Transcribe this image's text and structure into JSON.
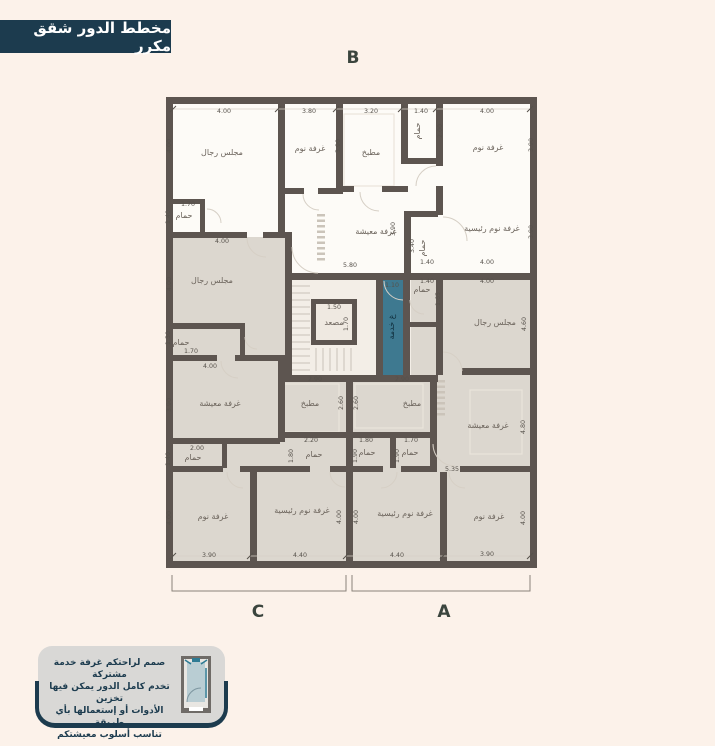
{
  "title": "مخطط الدور شقق مكرر",
  "section_labels": {
    "top": "B",
    "bottom_left": "C",
    "bottom_right": "A"
  },
  "note": {
    "lines": [
      "صمم لراحتكم غرفة خدمة مشتركة",
      "تخدم كامل الدور يمكن فيها تخزين",
      "الأدوات أو إستعمالها بأي طريقة",
      "تناسب أسلوب معيشتكم"
    ]
  },
  "colors": {
    "background": "#fcf2ea",
    "banner_navy": "#1c3b4e",
    "wall": "#5d5550",
    "room_beige": "#dcd7cf",
    "room_white": "#fdfbf7",
    "service_teal": "#3e7990",
    "note_gray": "#d9d8d6"
  },
  "plan": {
    "rooms": [
      {
        "t": "مجلس رجال",
        "x": 222,
        "y": 155
      },
      {
        "t": "غرفة نوم",
        "x": 310,
        "y": 151
      },
      {
        "t": "مطبخ",
        "x": 371,
        "y": 155
      },
      {
        "t": "حمام",
        "x": 420,
        "y": 131,
        "r": -90
      },
      {
        "t": "غرفة نوم",
        "x": 488,
        "y": 150
      },
      {
        "t": "حمام",
        "x": 184,
        "y": 218
      },
      {
        "t": "غرفة معيشة",
        "x": 376,
        "y": 234
      },
      {
        "t": "حمام",
        "x": 425,
        "y": 248,
        "r": -90
      },
      {
        "t": "غرفة نوم رئيسية",
        "x": 492,
        "y": 231
      },
      {
        "t": "مصعد",
        "x": 334,
        "y": 325
      },
      {
        "t": "غ خدمة",
        "x": 394,
        "y": 327,
        "r": -90,
        "c": "teal-label"
      },
      {
        "t": "مجلس رجال",
        "x": 212,
        "y": 283
      },
      {
        "t": "حمام",
        "x": 181,
        "y": 345
      },
      {
        "t": "غرفة معيشة",
        "x": 220,
        "y": 406
      },
      {
        "t": "حمام",
        "x": 193,
        "y": 460
      },
      {
        "t": "مطبخ",
        "x": 310,
        "y": 406
      },
      {
        "t": "حمام",
        "x": 314,
        "y": 457
      },
      {
        "t": "غرفة نوم",
        "x": 213,
        "y": 519
      },
      {
        "t": "غرفة نوم رئيسية",
        "x": 302,
        "y": 513
      },
      {
        "t": "حمام",
        "x": 422,
        "y": 292
      },
      {
        "t": "مجلس رجال",
        "x": 495,
        "y": 325
      },
      {
        "t": "مطبخ",
        "x": 412,
        "y": 406
      },
      {
        "t": "حمام",
        "x": 367,
        "y": 455
      },
      {
        "t": "حمام",
        "x": 410,
        "y": 455
      },
      {
        "t": "غرفة معيشة",
        "x": 488,
        "y": 428
      },
      {
        "t": "غرفة نوم رئيسية",
        "x": 405,
        "y": 516
      },
      {
        "t": "غرفة نوم",
        "x": 489,
        "y": 519
      }
    ],
    "dims": [
      {
        "t": "4.00",
        "x": 224,
        "y": 113
      },
      {
        "t": "3.80",
        "x": 309,
        "y": 113
      },
      {
        "t": "3.20",
        "x": 371,
        "y": 113
      },
      {
        "t": "1.40",
        "x": 421,
        "y": 113
      },
      {
        "t": "4.00",
        "x": 487,
        "y": 113
      },
      {
        "t": "4.00",
        "x": 171,
        "y": 146,
        "r": -90
      },
      {
        "t": "3.90",
        "x": 340,
        "y": 146,
        "r": -90
      },
      {
        "t": "2.00",
        "x": 442,
        "y": 131,
        "r": -90
      },
      {
        "t": "3.90",
        "x": 533,
        "y": 145,
        "r": -90
      },
      {
        "t": "1.70",
        "x": 188,
        "y": 206
      },
      {
        "t": "1.40",
        "x": 170,
        "y": 217,
        "r": -90
      },
      {
        "t": "3.90",
        "x": 395,
        "y": 229,
        "r": -90
      },
      {
        "t": "3.40",
        "x": 414,
        "y": 246,
        "r": -90
      },
      {
        "t": "3.90",
        "x": 533,
        "y": 232,
        "r": -90
      },
      {
        "t": "5.80",
        "x": 350,
        "y": 267
      },
      {
        "t": "1.40",
        "x": 427,
        "y": 264
      },
      {
        "t": "4.00",
        "x": 487,
        "y": 264
      },
      {
        "t": "1.40",
        "x": 427,
        "y": 283
      },
      {
        "t": "4.00",
        "x": 487,
        "y": 283
      },
      {
        "t": "1.10",
        "x": 392,
        "y": 287
      },
      {
        "t": "1.50",
        "x": 334,
        "y": 309
      },
      {
        "t": "1.70",
        "x": 348,
        "y": 324,
        "r": -90
      },
      {
        "t": "1.65",
        "x": 440,
        "y": 299,
        "r": -90
      },
      {
        "t": "4.00",
        "x": 222,
        "y": 243
      },
      {
        "t": "4.00",
        "x": 171,
        "y": 284,
        "r": -90
      },
      {
        "t": "4.60",
        "x": 526,
        "y": 324,
        "r": -90
      },
      {
        "t": "1.70",
        "x": 191,
        "y": 353
      },
      {
        "t": "1.30",
        "x": 170,
        "y": 338,
        "r": -90
      },
      {
        "t": "4.00",
        "x": 210,
        "y": 368
      },
      {
        "t": "3.90",
        "x": 171,
        "y": 405,
        "r": -90
      },
      {
        "t": "2.90",
        "x": 315,
        "y": 381
      },
      {
        "t": "2.60",
        "x": 343,
        "y": 403,
        "r": -90
      },
      {
        "t": "2.60",
        "x": 358,
        "y": 403,
        "r": -90
      },
      {
        "t": "2.90",
        "x": 402,
        "y": 381
      },
      {
        "t": "2.00",
        "x": 197,
        "y": 450
      },
      {
        "t": "1.40",
        "x": 170,
        "y": 459,
        "r": -90
      },
      {
        "t": "2.20",
        "x": 311,
        "y": 442
      },
      {
        "t": "1.80",
        "x": 293,
        "y": 456,
        "r": -90
      },
      {
        "t": "1.80",
        "x": 366,
        "y": 442
      },
      {
        "t": "1.90",
        "x": 357,
        "y": 456,
        "r": -90
      },
      {
        "t": "1.70",
        "x": 411,
        "y": 442
      },
      {
        "t": "1.90",
        "x": 399,
        "y": 456,
        "r": -90
      },
      {
        "t": "5.35",
        "x": 452,
        "y": 471
      },
      {
        "t": "4.80",
        "x": 525,
        "y": 427,
        "r": -90
      },
      {
        "t": "3.90",
        "x": 209,
        "y": 557
      },
      {
        "t": "4.40",
        "x": 300,
        "y": 557
      },
      {
        "t": "4.40",
        "x": 397,
        "y": 557
      },
      {
        "t": "3.90",
        "x": 487,
        "y": 556
      },
      {
        "t": "4.00",
        "x": 171,
        "y": 518,
        "r": -90
      },
      {
        "t": "4.00",
        "x": 341,
        "y": 517,
        "r": -90
      },
      {
        "t": "4.00",
        "x": 358,
        "y": 517,
        "r": -90
      },
      {
        "t": "4.00",
        "x": 525,
        "y": 518,
        "r": -90
      }
    ]
  }
}
